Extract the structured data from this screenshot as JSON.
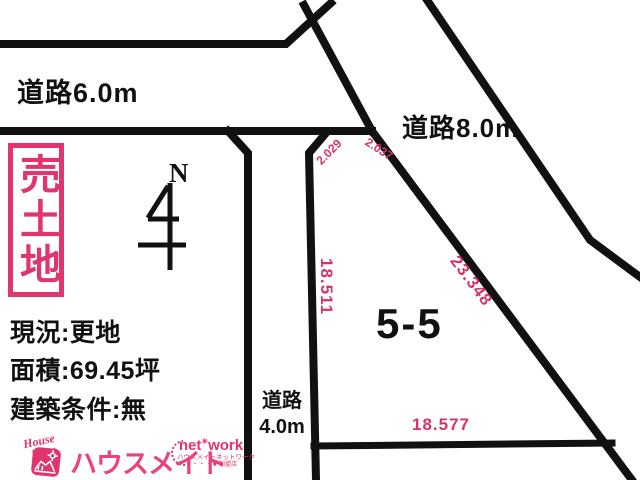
{
  "colors": {
    "pink_label": "#d63369",
    "pink_brand": "#e0356f",
    "line_black": "#111111"
  },
  "roads": {
    "road_6m_label": "道路6.0m",
    "road_8m_label": "道路8.0m",
    "road_4m_line1": "道路",
    "road_4m_line2": "4.0m"
  },
  "sale_badge": {
    "text": "売土地"
  },
  "north": {
    "label": "N"
  },
  "plot": {
    "number": "5-5"
  },
  "measurements": {
    "west_side": "18.511",
    "east_side": "23.348",
    "south_side": "18.577",
    "chamfer_left": "2.029",
    "chamfer_right": "2.037"
  },
  "details": {
    "line1": "現況:更地",
    "line2": "面積:69.45坪",
    "line3": "建築条件:無"
  },
  "footer": {
    "housemate_script_word1": "House",
    "housemate_script_word2": "Mate",
    "housemate_katakana": "ハウスメイト",
    "network_word1": "net",
    "network_star": "✳",
    "network_word2": "work",
    "network_sub": "ハウスメイトネットワーク",
    "network_member_dots": "・・・・■",
    "network_member": "加盟店"
  }
}
